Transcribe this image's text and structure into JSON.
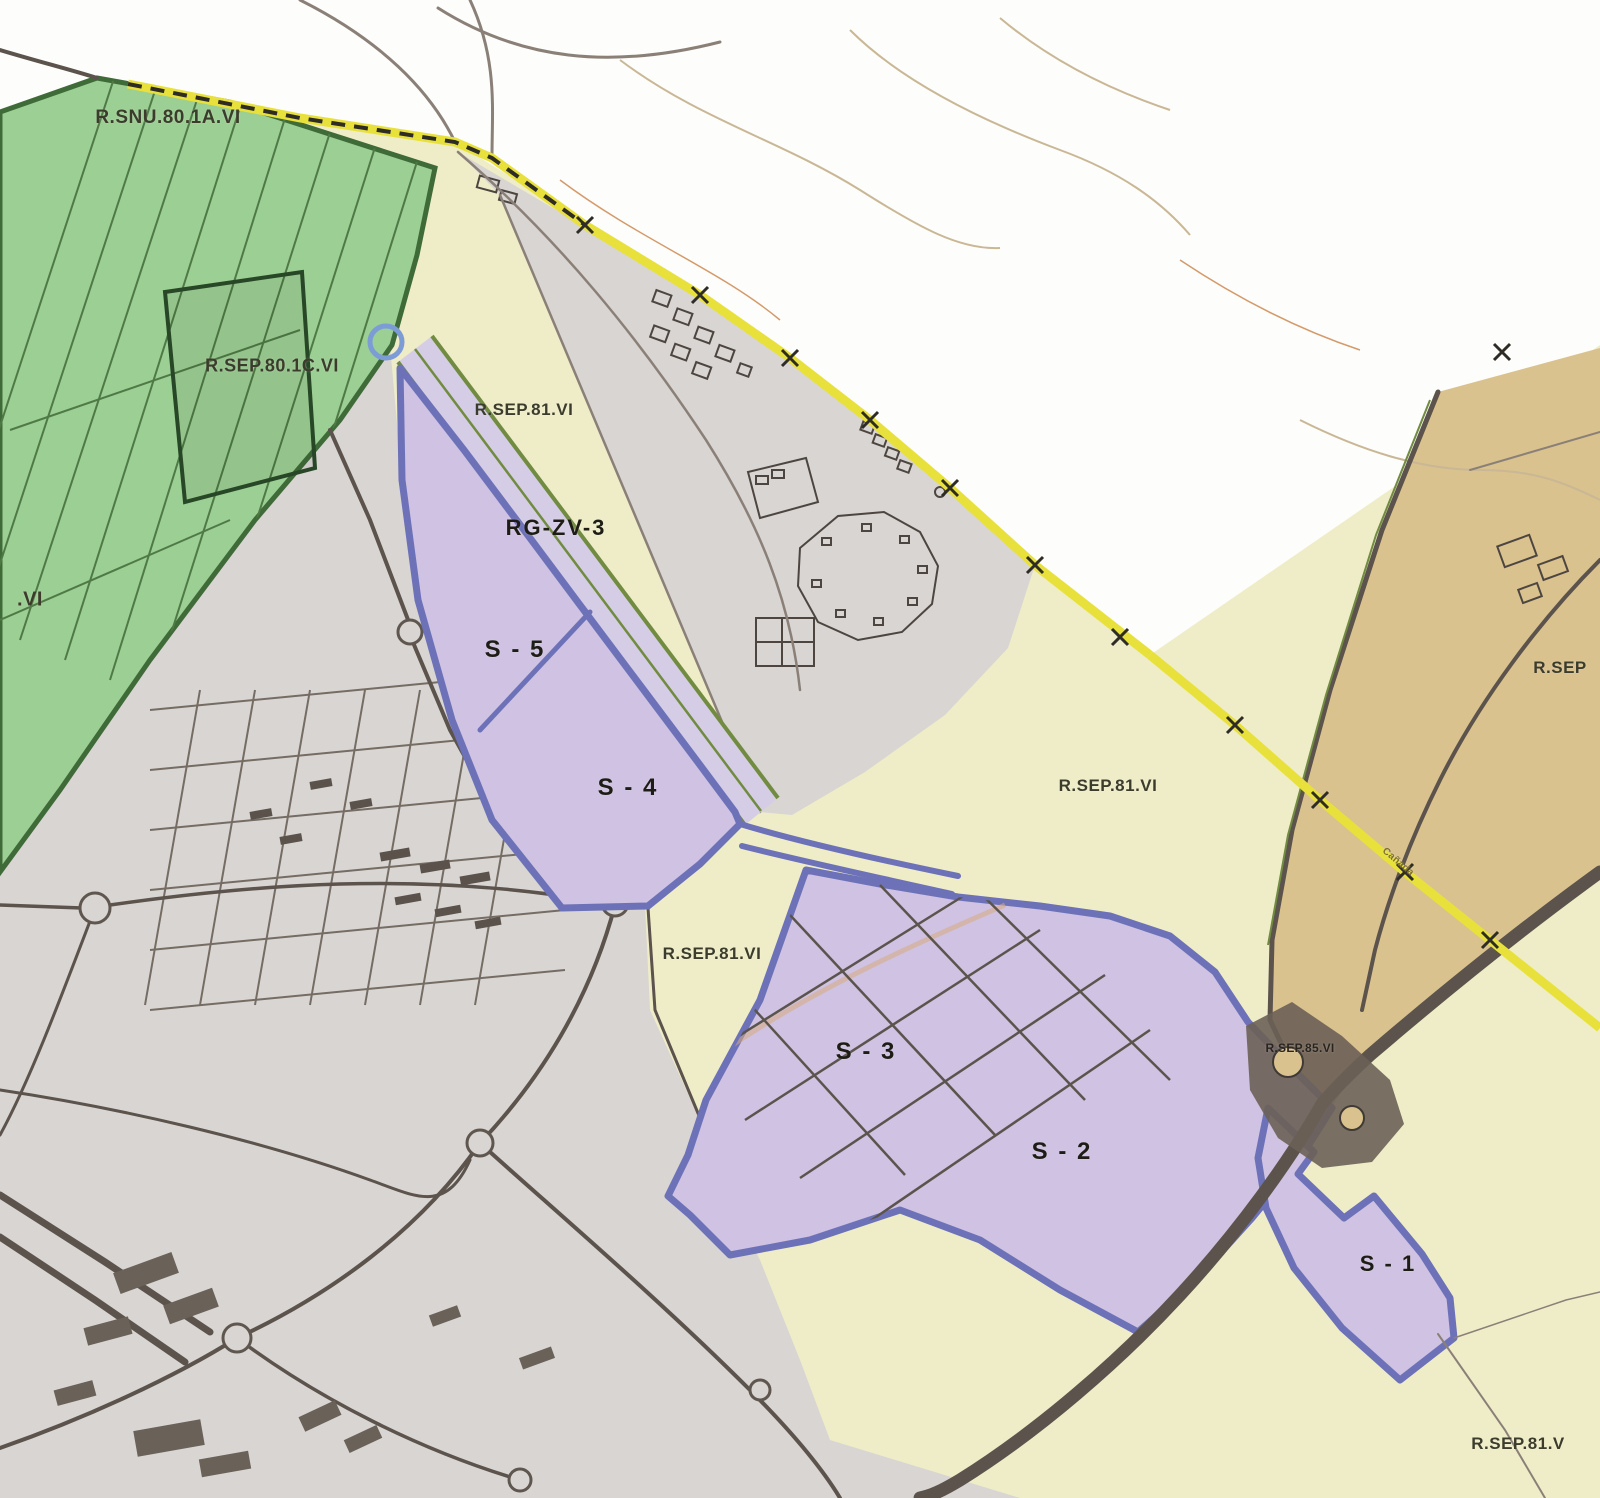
{
  "labels": {
    "region_rsnu_80_1a": "R.SNU.80.1A.VI",
    "region_rsep_80_1c": "R.SEP.80.1C.VI",
    "region_left_edge": ".VI",
    "region_rsep_81_north": "R.SEP.81.VI",
    "zone_rg_zv_3": "RG-ZV-3",
    "sector_s5": "S - 5",
    "sector_s4": "S - 4",
    "region_rsep_81_east": "R.SEP.81.VI",
    "region_rsep_81_center": "R.SEP.81.VI",
    "sector_s3": "S - 3",
    "sector_s2": "S - 2",
    "sector_s1": "S - 1",
    "region_rsep_85": "R.SEP.85.VI",
    "region_rsep_right_edge": "R.SEP",
    "region_rsep_81_southeast": "R.SEP.81.V",
    "road_canada": "Cañada"
  },
  "colors": {
    "white_bg": "#fdfdfb",
    "zone_cream": "#efedc8",
    "zone_gray": "#d8d5d2",
    "zone_green": "#9ccf94",
    "zone_green_line": "#3f6b38",
    "zone_tan": "#d9c28e",
    "zone_purple": "#cfc2e2",
    "border_blue": "#6d72b8",
    "road_dark": "#5b534c",
    "road_light": "#8a8078",
    "boundary_yellow": "#e8e13c",
    "dash_black": "#2e2c24",
    "olive_line": "#718b41",
    "contour_tan": "#c9b795",
    "label_dark": "#3c3c2c"
  }
}
